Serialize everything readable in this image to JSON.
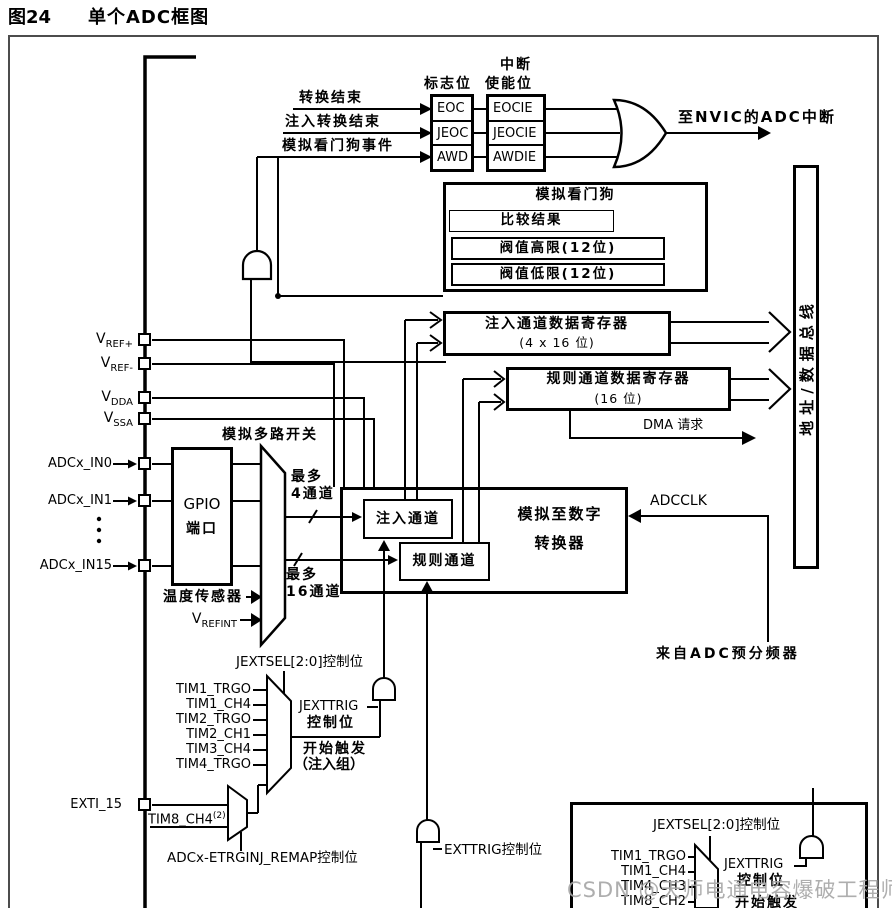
{
  "figure": {
    "number": "图24",
    "title": "单个ADC框图"
  },
  "interrupt": {
    "inputs": [
      "转换结束",
      "注入转换结束",
      "模拟看门狗事件"
    ],
    "flag_header": "标志位",
    "enable_header": [
      "中断",
      "使能位"
    ],
    "flags": [
      "EOC",
      "JEOC",
      "AWD"
    ],
    "enables": [
      "EOCIE",
      "JEOCIE",
      "AWDIE"
    ],
    "nvic_label": "至NVIC的ADC中断"
  },
  "watchdog": {
    "title": "模拟看门狗",
    "compare": "比较结果",
    "high_threshold": "阀值高限(12位)",
    "low_threshold": "阀值低限(12位)"
  },
  "registers": {
    "injected": [
      "注入通道数据寄存器",
      "(4 x 16 位)"
    ],
    "regular": [
      "规则通道数据寄存器",
      "(16 位)"
    ],
    "dma_label": "DMA 请求"
  },
  "bus_label": "地址/数据总线",
  "pins": {
    "vref_plus": {
      "main": "V",
      "sub": "REF+"
    },
    "vref_minus": {
      "main": "V",
      "sub": "REF-"
    },
    "vdda": {
      "main": "V",
      "sub": "DDA"
    },
    "vssa": {
      "main": "V",
      "sub": "SSA"
    },
    "in0": "ADCx_IN0",
    "in1": "ADCx_IN1",
    "in15": "ADCx_IN15",
    "exti15": "EXTI_15"
  },
  "analog_path": {
    "gpio": [
      "GPIO",
      "端口"
    ],
    "mux_label": "模拟多路开关",
    "max4": [
      "最多",
      "4通道"
    ],
    "max16": [
      "最多",
      "16通道"
    ],
    "temp_sensor": "温度传感器",
    "vrefint": {
      "main": "V",
      "sub": "REFINT"
    }
  },
  "core": {
    "injected": "注入通道",
    "regular": "规则通道",
    "adc": [
      "模拟至数字",
      "转换器"
    ],
    "adcclk": "ADCCLK",
    "prescaler": "来自ADC预分频器"
  },
  "injected_trigger": {
    "jextsel": "JEXTSEL[2:0]控制位",
    "sources": [
      "TIM1_TRGO",
      "TIM1_CH4",
      "TIM2_TRGO",
      "TIM2_CH1",
      "TIM3_CH4",
      "TIM4_TRGO"
    ],
    "jexttrig": [
      "JEXTTRIG",
      "控制位"
    ],
    "start": [
      "开始触发",
      "（注入组）"
    ],
    "tim8": {
      "main": "TIM8_CH4",
      "sup": "(2)"
    },
    "remap": "ADCx-ETRGINJ_REMAP控制位"
  },
  "exttrig_label": "EXTTRIG控制位",
  "regular_trigger": {
    "jextsel": "JEXTSEL[2:0]控制位",
    "sources": [
      "TIM1_TRGO",
      "TIM1_CH4",
      "TIM4_CH3",
      "TIM8_CH2"
    ],
    "jexttrig": [
      "JEXTTRIG",
      "控制位"
    ],
    "start": "开始触发"
  },
  "watermark": "CSDN @天师电通电容爆破工程师",
  "colors": {
    "line": "#000000",
    "frame": "#4c4c4c",
    "watermark": "#a5a5a5",
    "background": "#ffffff"
  }
}
